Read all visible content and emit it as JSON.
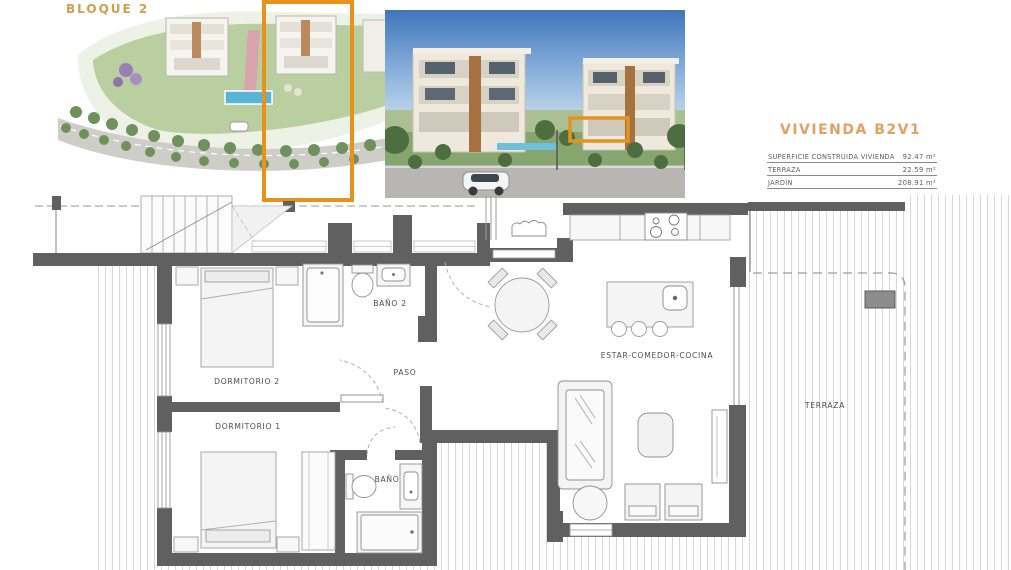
{
  "site_plan": {
    "label": "BLOQUE 2"
  },
  "unit_info": {
    "title": "VIVIENDA B2V1",
    "table": [
      {
        "label": "SUPERFICIE CONSTRUIDA VIVIENDA",
        "value": "92.47 m²"
      },
      {
        "label": "TERRAZA",
        "value": "22.59 m²"
      },
      {
        "label": "JARDÍN",
        "value": "208.91 m²"
      }
    ]
  },
  "floorplan": {
    "rooms": {
      "dormitorio2": "DORMITORIO 2",
      "dormitorio1": "DORMITORIO 1",
      "bano2": "BAÑO 2",
      "bano": "BAÑO",
      "paso": "PASO",
      "estar_comedor_cocina": "ESTAR-COMEDOR-COCINA",
      "terraza": "TERRAZA"
    }
  },
  "colors": {
    "accent_orange": "#E8921E",
    "gold_label": "#CDA04A",
    "wall_gray": "#606060"
  }
}
